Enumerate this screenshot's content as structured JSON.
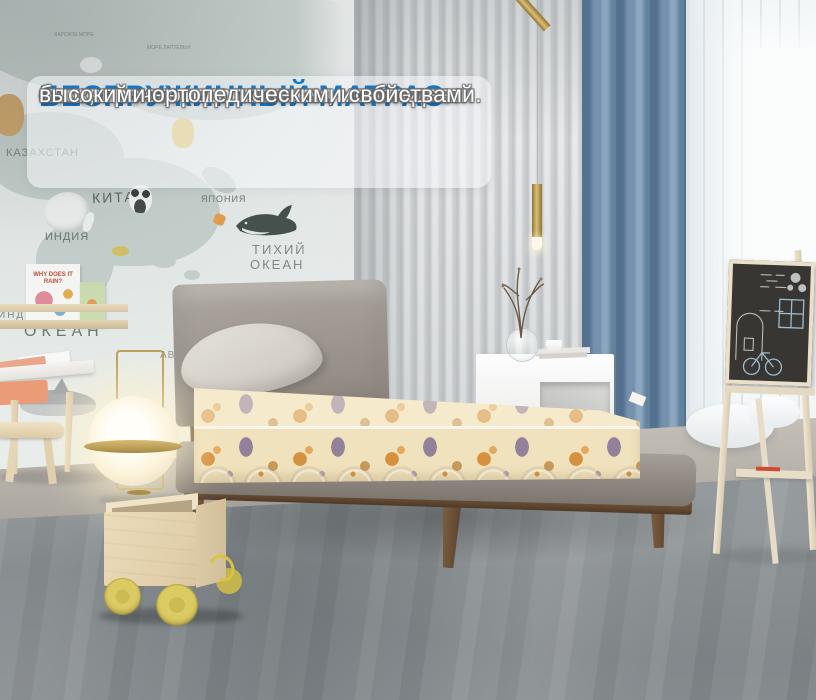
{
  "overlay": {
    "title": "БЕСПРУЖИННЫЙ МАТРАС",
    "body_lines": [
      "основой которого является монолитный",
      "блок, прочен и долговечен, и обладает",
      "высокими ортопедическими свойствами."
    ]
  },
  "map": {
    "labels": {
      "russia": "РОССИЯ",
      "kara_sea": "КАРСКОЕ МОРЕ",
      "laptev_sea": "МОРЕ ЛАПТЕВЫХ",
      "kazakhstan": "КАЗАХСТАН",
      "china": "КИТАЙ",
      "japan": "ЯПОНИЯ",
      "india": "ИНДИЯ",
      "pacific_line1": "ТИХИЙ",
      "pacific_line2": "ОКЕАН",
      "indian_ocean_partial": "ИНД",
      "ocean": "ОКЕАН",
      "abc": "АВС"
    }
  },
  "shelf": {
    "book1_title": "WHY DOES IT RAIN?"
  },
  "colors": {
    "accent_blue": "#1478c8",
    "overlay_bg": "rgba(244,247,249,0.58)",
    "land": "#c8d2ce",
    "curtain_blue": "#6d8ca9",
    "mattress_cream": "#f0e2bc",
    "pattern_orange": "#d6913f",
    "pattern_plum": "#93819b",
    "wood_brown": "#6f5539",
    "gold": "#bb9e55",
    "wheel_yellow": "#d9c75e",
    "drawer_salmon": "#ec9d77",
    "chalkboard": "#383632",
    "carpet": "#82888b",
    "headboard_gray": "#98918a"
  }
}
